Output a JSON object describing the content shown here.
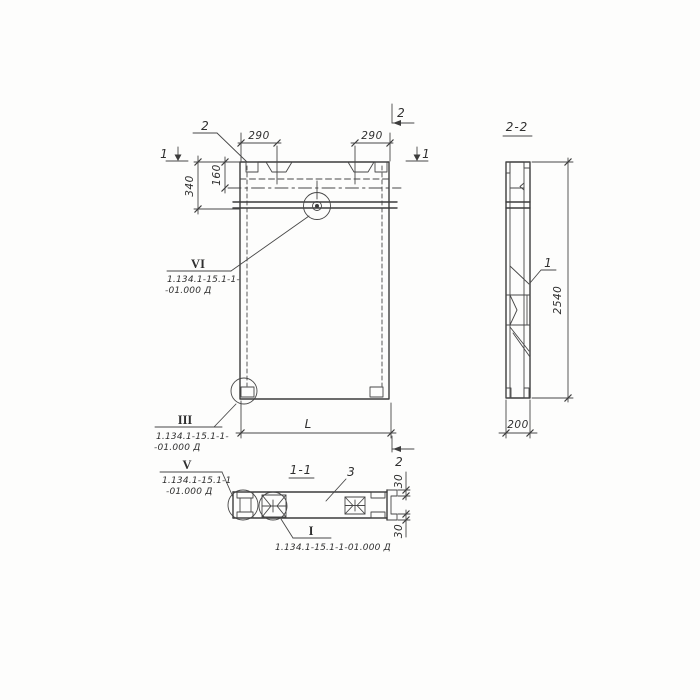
{
  "drawing": {
    "background": "#fdfdfc",
    "line_color": "#3c3c3c",
    "front_view": {
      "marker_1_left": "1",
      "marker_1_right": "1",
      "marker_2_top": "2",
      "marker_2_bottom": "2",
      "callout_2": "2",
      "dim_290_left": "290",
      "dim_290_right": "290",
      "dim_160": "160",
      "dim_340": "340",
      "dim_length": "L",
      "detail_vi": {
        "numeral": "VI",
        "ref_line1": "1.134.1-15.1-1-",
        "ref_line2": "-01.000 Д"
      },
      "detail_iii": {
        "numeral": "III",
        "ref_line1": "1.134.1-15.1-1-",
        "ref_line2": "-01.000 Д"
      }
    },
    "section_1_1": {
      "title": "1-1",
      "callout_3": "3",
      "dim_30_top": "30",
      "dim_30_bottom": "30",
      "detail_v": {
        "numeral": "V",
        "ref_line1": "1.134.1-15.1-1",
        "ref_line2": "-01.000 Д"
      },
      "detail_i": {
        "numeral": "I",
        "ref": "1.134.1-15.1-1-01.000 Д"
      }
    },
    "section_2_2": {
      "title": "2-2",
      "callout_1": "1",
      "dim_2540": "2540",
      "dim_200": "200"
    }
  }
}
